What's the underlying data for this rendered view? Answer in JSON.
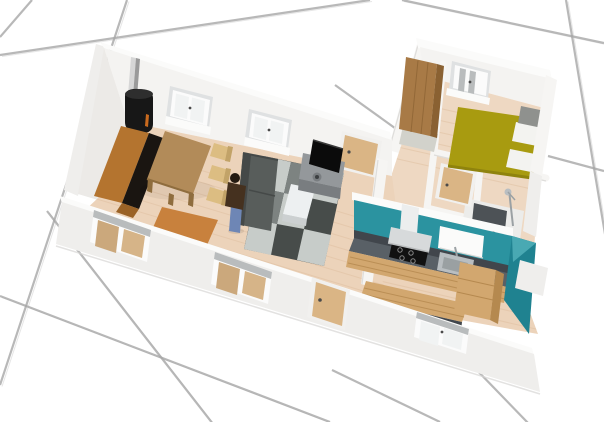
{
  "scene": {
    "view": "3d-floorplan-perspective",
    "ground": "white-tiles",
    "rooms": [
      "living-room",
      "kitchen",
      "hallway",
      "bedroom",
      "bathroom"
    ],
    "objects": [
      "wood-stove",
      "stove-pipe",
      "sideboard",
      "dining-table",
      "chair",
      "chair",
      "chair",
      "bench",
      "sofa",
      "person",
      "rug",
      "coffee-table",
      "tv-stand",
      "tv",
      "kitchen-counter",
      "cooktop",
      "range-hood",
      "wall-cabinet",
      "kitchen-sink",
      "kitchen-island",
      "drawer-unit",
      "bed",
      "pillow",
      "pillow",
      "nightstand",
      "wardrobe",
      "shoe-mat",
      "shower",
      "bathroom-sink",
      "bath-panel"
    ],
    "window_count": 6,
    "door_count": 3,
    "colors": {
      "ground": "#ffffff",
      "grout": "#a6a6a6",
      "grout_soft": "#e3e3e3",
      "wall_white": "#f6f5f3",
      "wall_light": "#efeeec",
      "wall_ridge": "#fbfbfa",
      "wall_inner": "#f4f3f1",
      "wall_inner_side": "#eceae7",
      "wall_edge": "#d8d7d5",
      "floor_wood": "#ecd3ba",
      "floor_streak": "#ddbd9e",
      "floor_hall": "#eed8c2",
      "floor_bath": "#ececea",
      "teal": "#2b93a0",
      "teal_dark": "#1f8290",
      "teal_light": "#49a9b3",
      "counter_dark": "#41464c",
      "counter_top": "#596066",
      "cooktop": "#111111",
      "steel": "#b9bec1",
      "basin": "#9aa0a2",
      "chrome": "#9ba1a4",
      "hood": "#d7dadb",
      "hood_light": "#eceeee",
      "cabinet_wood": "#d2a76f",
      "cabinet_wood_dark": "#b5894f",
      "stove": "#171717",
      "stove_rim": "#2e2e2e",
      "pipe_light": "#d6d6d6",
      "pipe_dark": "#9a9a9a",
      "fire": "#c96a1e",
      "sideboard_top": "#b4742f",
      "sideboard_front": "#1a1511",
      "sideboard_base": "#9a6226",
      "table_wood": "#b28b59",
      "table_side": "#8f6d3e",
      "chair_wood": "#dcbd82",
      "chair_dark": "#c2a368",
      "bench_wood": "#c8813d",
      "bench_side": "#aa682c",
      "sofa": "#585d5b",
      "sofa_dark": "#454948",
      "rug_dark": "#474c4a",
      "rug_light": "#c7ccc9",
      "rug_mid": "#7d8381",
      "coffee": "#edf0f1",
      "coffee_shade": "#ccd0d1",
      "tvstand": "#94989b",
      "tvstand_dark": "#797d80",
      "tv": "#0b0b0b",
      "hair": "#241a11",
      "jacket": "#45311f",
      "jeans": "#6e86b5",
      "door_wood": "#dab585",
      "door_frame": "#f1f0ee",
      "handle": "#4a4a4a",
      "window_recess": "#dfe1e2",
      "window_frame": "#fbfbfb",
      "window_glass": "#f1f3f3",
      "window_shadow": "#b9bcbd",
      "window_interior": "#cba87c",
      "window_interior2": "#d6b488",
      "bed": "#a89b10",
      "bed_dark": "#8f830d",
      "pillow": "#f3f3f0",
      "nightstand": "#8f918e",
      "wardrobe": "#a87a46",
      "wardrobe_dark": "#8a6132",
      "bath_panel": "#4d5256",
      "sink": "#f6f7f7",
      "mat": "#d2d2cb"
    }
  }
}
